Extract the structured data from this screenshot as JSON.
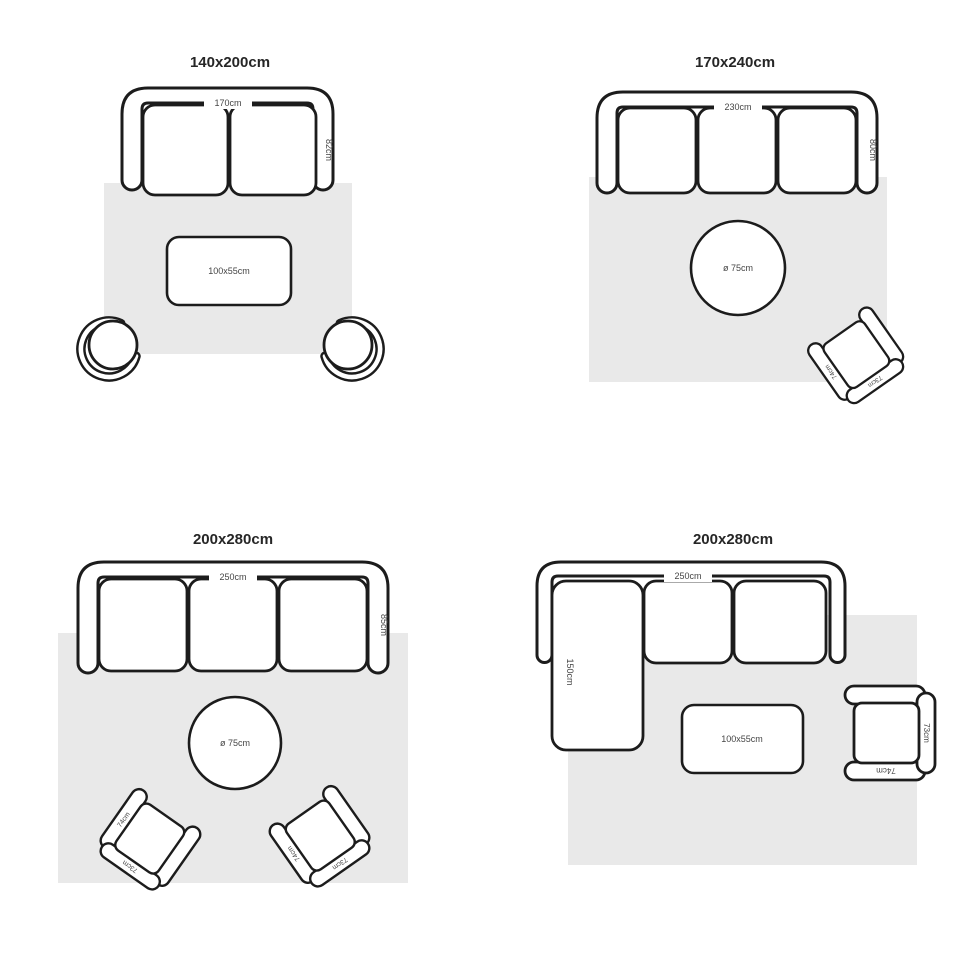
{
  "palette": {
    "background": "#ffffff",
    "line": "#1c1c1c",
    "rug": "#e9e9e9",
    "dimension_label": "#454545",
    "title": "#262626"
  },
  "armchair": {
    "arm_label": "74cm",
    "back_label": "73cm"
  },
  "quadrants": {
    "top_left": {
      "title": "140x200cm",
      "sofa": {
        "width_label": "170cm",
        "depth_label": "82cm"
      },
      "coffee_table": {
        "label": "100x55cm"
      }
    },
    "top_right": {
      "title": "170x240cm",
      "sofa": {
        "width_label": "230cm",
        "depth_label": "80cm"
      },
      "round_table": {
        "label": "ø 75cm"
      }
    },
    "bottom_left": {
      "title": "200x280cm",
      "sofa": {
        "width_label": "250cm",
        "depth_label": "85cm"
      },
      "round_table": {
        "label": "ø 75cm"
      }
    },
    "bottom_right": {
      "title": "200x280cm",
      "sofa": {
        "width_label": "250cm",
        "chaise_label": "150cm"
      },
      "coffee_table": {
        "label": "100x55cm"
      }
    }
  }
}
